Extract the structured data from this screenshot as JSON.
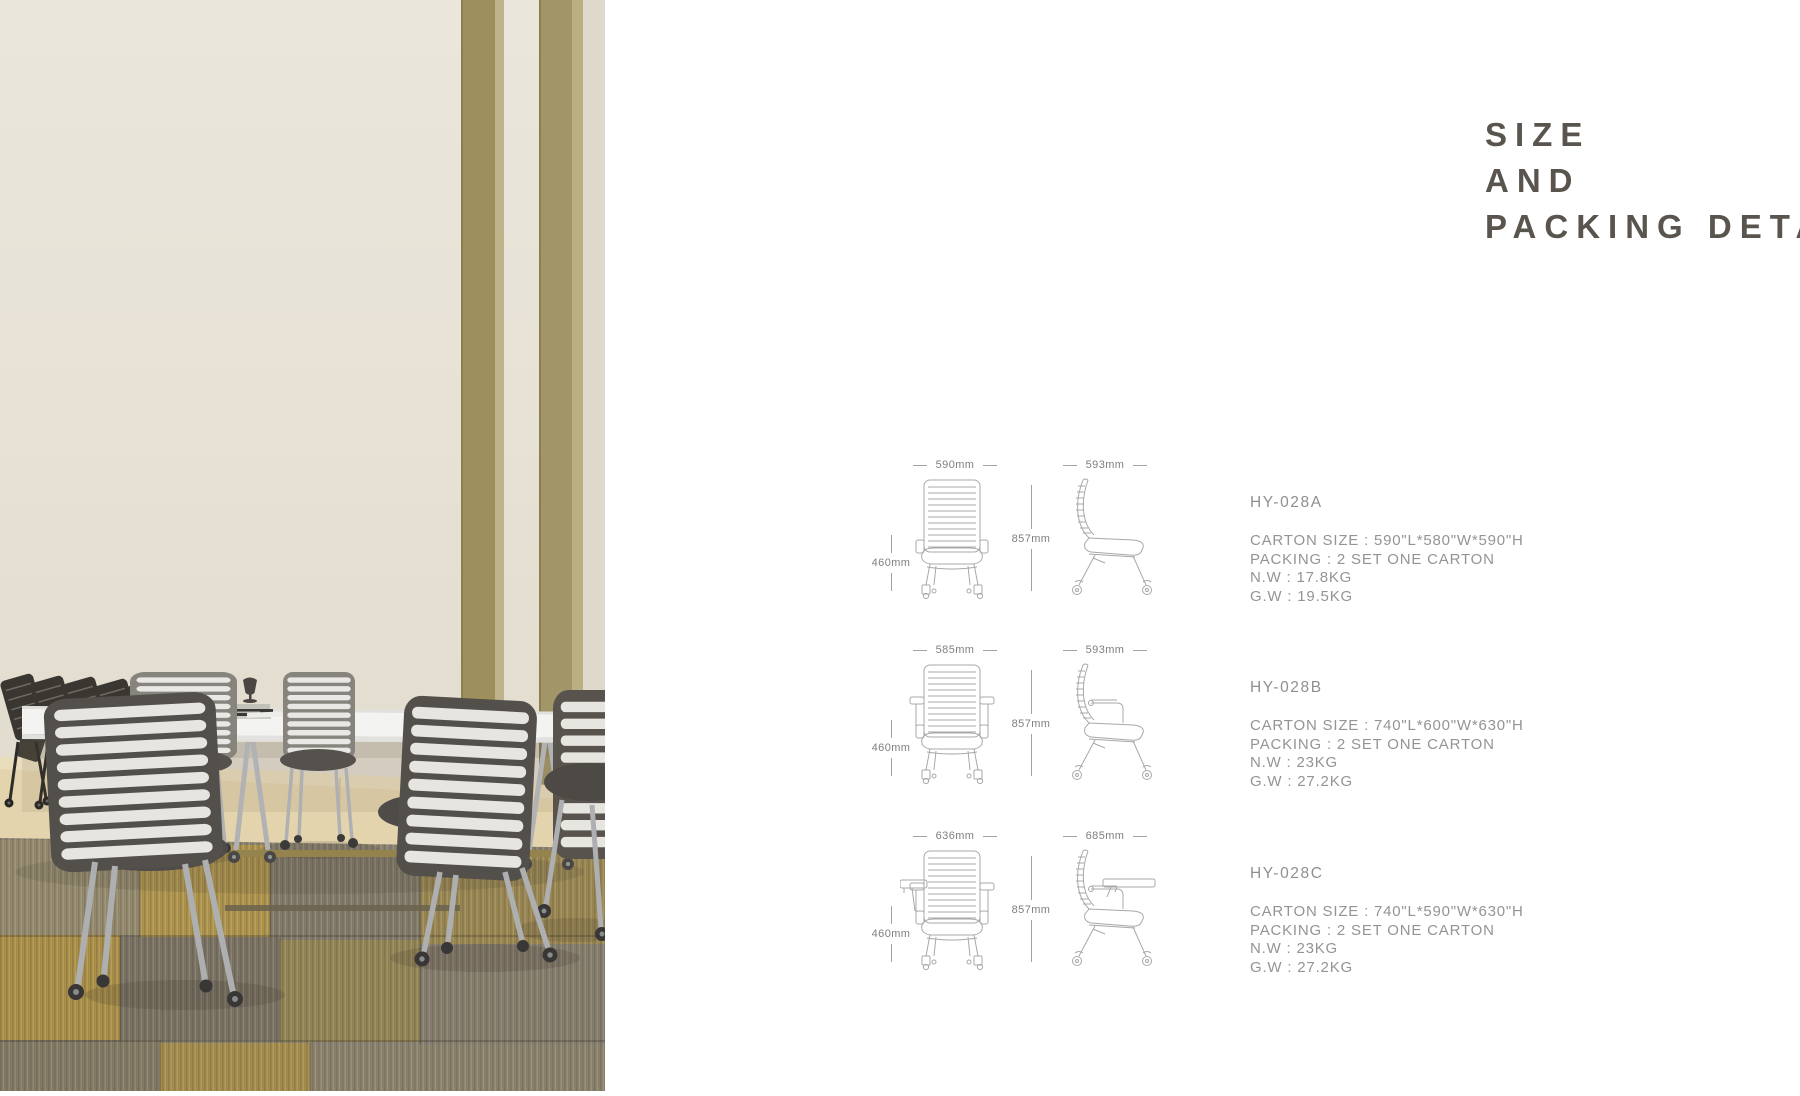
{
  "title": {
    "lines": [
      "SIZE",
      "AND",
      "PACKING DETAILS"
    ]
  },
  "products": [
    {
      "model": "HY-028A",
      "front_width": "590mm",
      "side_width": "593mm",
      "total_height": "857mm",
      "seat_height": "460mm",
      "specs": [
        "CARTON SIZE : 590\"L*580\"W*590\"H",
        "PACKING : 2 SET ONE CARTON",
        "N.W : 17.8KG",
        "G.W : 19.5KG"
      ]
    },
    {
      "model": "HY-028B",
      "front_width": "585mm",
      "side_width": "593mm",
      "total_height": "857mm",
      "seat_height": "460mm",
      "specs": [
        "CARTON SIZE : 740\"L*600\"W*630\"H",
        "PACKING : 2 SET ONE CARTON",
        "N.W : 23KG",
        "G.W : 27.2KG"
      ]
    },
    {
      "model": "HY-028C",
      "front_width": "636mm",
      "side_width": "685mm",
      "total_height": "857mm",
      "seat_height": "460mm",
      "specs": [
        "CARTON SIZE : 740\"L*590\"W*630\"H",
        "PACKING : 2 SET ONE CARTON",
        "N.W : 23KG",
        "G.W : 27.2KG"
      ]
    }
  ],
  "photo": {
    "alt": "Meeting room with white conference table and stacking mesh-back chairs on casters"
  },
  "colors": {
    "title_text": "#59554e",
    "spec_text": "#949494",
    "dim_text": "#7f7f7f",
    "line_art": "#a8a8a8",
    "wall_cream": "#f0ebdf",
    "stripe_khaki": "#a2945f",
    "carpet_ochre": "#b2964a",
    "carpet_gray": "#8e8674",
    "brass_bar": "#98874f",
    "table_white": "#fbfbfa"
  }
}
